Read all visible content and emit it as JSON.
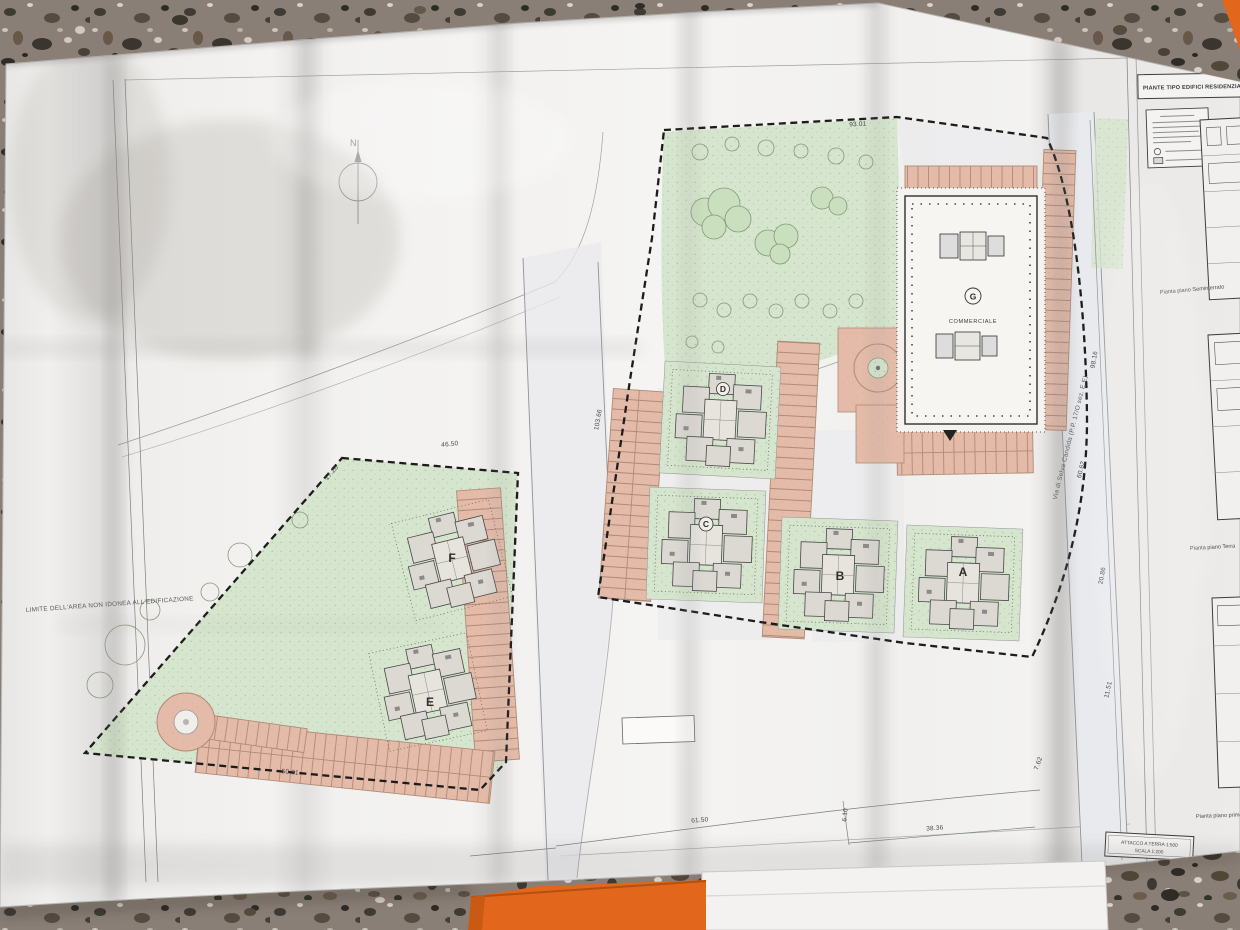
{
  "photo": {
    "floor_base_color": "#8a7f76",
    "orange_object_color": "#e2661c",
    "paper_color": "#f1f0ee"
  },
  "plan": {
    "north_label": "N",
    "site_note": "LIMITE DELL'AREA NON IDONEA ALL'EDIFICAZIONE",
    "road_label": "Via di Selva Candida (P.P. 17/O sez. E.E)",
    "road_dim": "60.62",
    "buildings": {
      "a": "A",
      "b": "B",
      "c": "C",
      "d": "D",
      "e": "E",
      "f": "F",
      "g": "G",
      "g_type": "COMMERCIALE"
    },
    "dimensions": {
      "dim_93_01": "93.01",
      "dim_46_50": "46.50",
      "dim_17_26": "17.26",
      "dim_50_31": "50.31",
      "dim_103_66": "103.66",
      "dim_61_50": "61.50",
      "dim_6_10": "6.10",
      "dim_38_36": "38.36",
      "dim_98_16": "98.16",
      "dim_20_86": "20.86",
      "dim_11_51": "11.51",
      "dim_7_62": "7.62"
    },
    "side_panel": {
      "title": "PIANTE TIPO EDIFICI RESIDENZIALI",
      "label_1": "Pianta piano Seminterrato",
      "label_2": "Pianta piano Terra",
      "label_3": "Pianta piano primo",
      "scale_1": "ATTACCO A TERRA 1:500",
      "scale_2": "SCALA 1:200"
    },
    "colors": {
      "green_area": "#d6e5cd",
      "parking_area": "#e4bba9",
      "building_fill": "#dcd9d3"
    }
  }
}
